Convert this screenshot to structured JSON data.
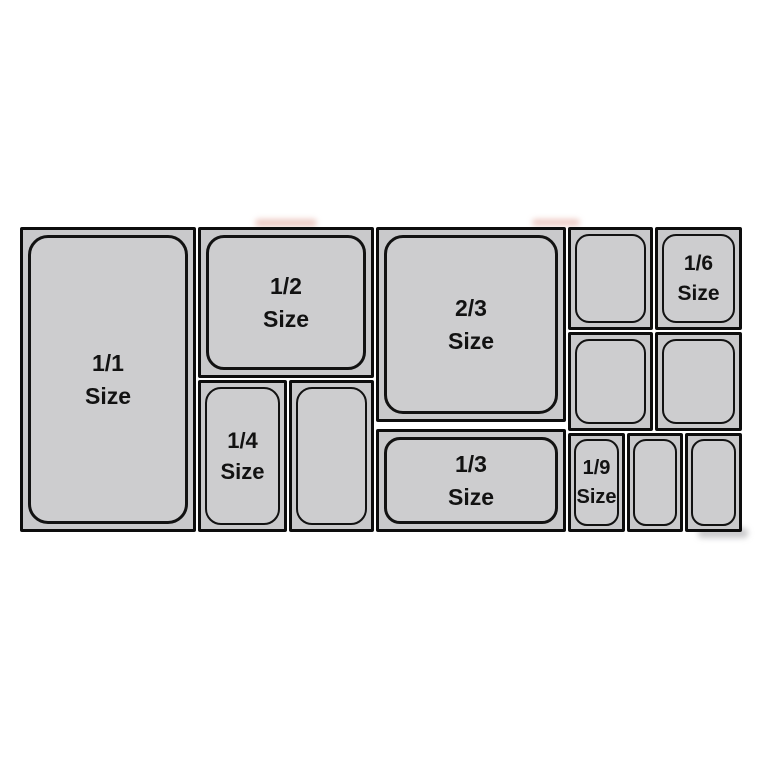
{
  "diagram": {
    "name": "Gastronorm pan size layout",
    "background_color": "#ffffff",
    "pan_fill_color": "#cdcdcf",
    "border_color": "#0d0d0d",
    "label_color": "#121212"
  },
  "pans": {
    "full": {
      "fraction": "1/1",
      "word": "Size"
    },
    "half": {
      "fraction": "1/2",
      "word": "Size"
    },
    "two_thirds": {
      "fraction": "2/3",
      "word": "Size"
    },
    "quarter": {
      "fraction": "1/4",
      "word": "Size"
    },
    "third": {
      "fraction": "1/3",
      "word": "Size"
    },
    "sixth": {
      "fraction": "1/6",
      "word": "Size"
    },
    "ninth": {
      "fraction": "1/9",
      "word": "Size"
    }
  }
}
